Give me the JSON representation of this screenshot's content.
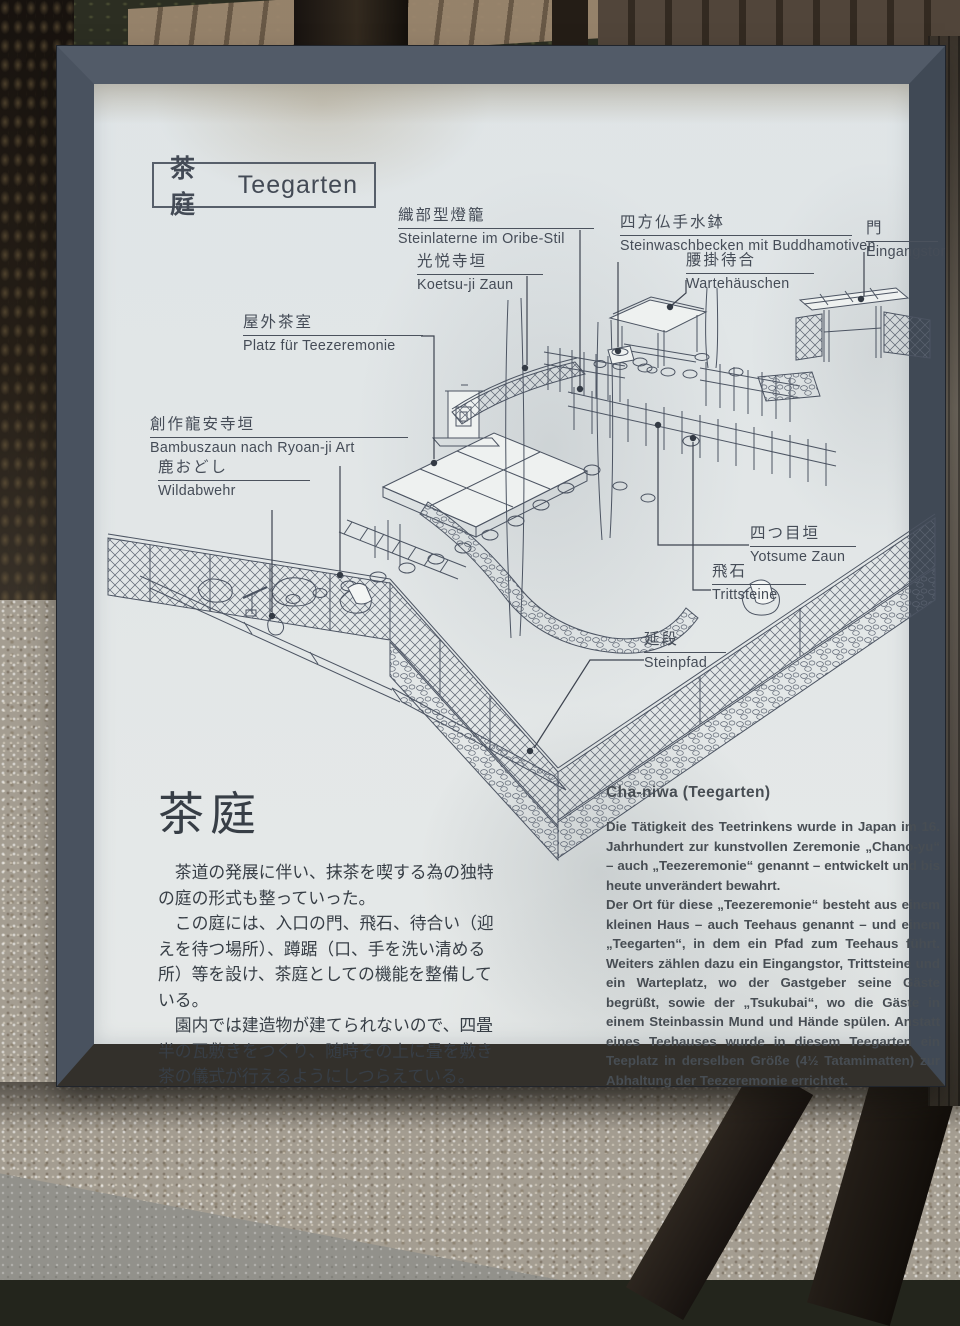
{
  "sign": {
    "title": {
      "jp": "茶庭",
      "de": "Teegarten"
    },
    "panel_color": "#e7eae9",
    "frame_color": "#47505d",
    "ink_color": "#454c57"
  },
  "diagram": {
    "labels": [
      {
        "id": "steinlaterne",
        "jp": "織部型燈籠",
        "de": "Steinlaterne im Oribe-Stil"
      },
      {
        "id": "koetsuji",
        "jp": "光悦寺垣",
        "de": "Koetsu-ji Zaun"
      },
      {
        "id": "teeplatz",
        "jp": "屋外茶室",
        "de": "Platz für Teezeremonie"
      },
      {
        "id": "basin",
        "jp": "四方仏手水鉢",
        "de": "Steinwaschbecken mit Buddhamotiven"
      },
      {
        "id": "wartehaus",
        "jp": "腰掛待合",
        "de": "Wartehäuschen"
      },
      {
        "id": "tor",
        "jp": "門",
        "de": "Eingangstor"
      },
      {
        "id": "bambuszaun",
        "jp": "創作龍安寺垣",
        "de": "Bambuszaun nach Ryoan-ji Art"
      },
      {
        "id": "wildabwehr",
        "jp": "鹿おどし",
        "de": "Wildabwehr"
      },
      {
        "id": "yotsume",
        "jp": "四つ目垣",
        "de": "Yotsume Zaun"
      },
      {
        "id": "trittsteine",
        "jp": "飛石",
        "de": "Trittsteine"
      },
      {
        "id": "steinpfad",
        "jp": "延段",
        "de": "Steinpfad"
      }
    ]
  },
  "jp_section": {
    "heading": "茶庭",
    "paragraphs": [
      "　茶道の発展に伴い、抹茶を喫する為の独特の庭の形式も整っていった。",
      "　この庭には、入口の門、飛石、待合い（迎えを待つ場所）、蹲踞（口、手を洗い清める所）等を設け、茶庭としての機能を整備している。",
      "　園内では建造物が建てられないので、四畳半の瓦敷きをつくり、随時その上に畳を敷き茶の儀式が行えるようにしつらえている。"
    ]
  },
  "de_section": {
    "heading": "Cha-niwa (Teegarten)",
    "paragraphs": [
      "Die Tätigkeit des Teetrinkens wurde in Japan im 16. Jahrhundert zur kunstvollen Zeremonie „Chano-yu“ – auch „Teezeremonie“ genannt – entwickelt und bis heute unverändert bewahrt.",
      "Der Ort für diese „Teezeremonie“ besteht aus einem kleinen Haus – auch Teehaus genannt – und einem „Teegarten“, in dem ein Pfad zum Teehaus führt. Weiters zählen dazu ein Eingangstor, Trittsteine und ein Warteplatz, wo der Gastgeber seine Gäste begrüßt, sowie der „Tsukubai“, wo die Gäste in einem Steinbassin Mund und Hände spülen. Anstatt eines Teehauses wurde in diesem Teegarten ein Teeplatz in derselben Größe (4½ Tatamimatten) zur Abhaltung der Teezeremonie errichtet."
    ]
  }
}
